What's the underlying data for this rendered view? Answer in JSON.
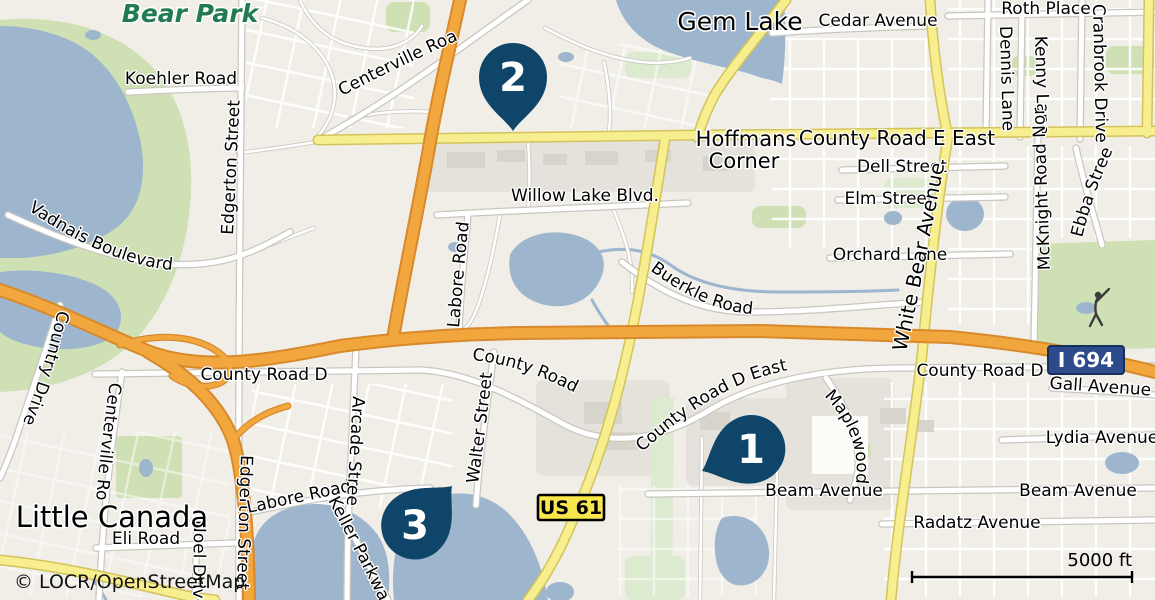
{
  "map": {
    "attribution": "© LOCR/OpenStreetMap",
    "scale": {
      "label": "5000 ft"
    },
    "markers": [
      {
        "number": "1"
      },
      {
        "number": "2"
      },
      {
        "number": "3"
      }
    ],
    "shields": {
      "i694": "I 694",
      "us61": "US 61"
    },
    "place_labels": {
      "bear_park": "Bear Park",
      "gem_lake": "Gem Lake",
      "hoffmans_corner_line1": "Hoffmans",
      "hoffmans_corner_line2": "Corner",
      "little_canada": "Little Canada"
    },
    "road_labels": {
      "koehler_road": "Koehler Road",
      "edgerton_street_north": "Edgerton Street",
      "centerville_road_north": "Centerville Road",
      "cedar_avenue": "Cedar Avenue",
      "roth_place": "Roth Place",
      "dennis_lane": "Dennis Lane",
      "kenny_lane": "Kenny Lane",
      "cranbrook_drive": "Cranbrook Drive",
      "county_road_e_east": "County Road E East",
      "dell_street": "Dell Street",
      "elm_street": "Elm Street",
      "willow_lake_blvd": "Willow Lake Blvd.",
      "orchard_lane": "Orchard Lane",
      "white_bear_avenue": "White Bear Avenue",
      "mcknight_road_north": "McKnight Road North",
      "ebba_street": "Ebba Street",
      "buerkle_road": "Buerkle Road",
      "vadnais_boulevard": "Vadnais Boulevard",
      "country_drive": "Country Drive",
      "centerville_road_south": "Centerville Road",
      "county_road_d_west": "County Road D",
      "county_road_d_mid": "County Road D",
      "county_road_d_east": "County Road D East",
      "county_road_d_right": "County Road D",
      "gall_avenue": "Gall Avenue",
      "lydia_avenue": "Lydia Avenue",
      "maplewood_mall_drive": "Maplewood Mall Drive",
      "beam_avenue_west": "Beam Avenue",
      "beam_avenue_east": "Beam Avenue",
      "radatz_avenue": "Radatz Avenue",
      "eli_road": "Eli Road",
      "noel_drive": "Noel Drive",
      "edgerton_street_south": "Edgerton Street",
      "labore_road_vertical": "Labore Road",
      "labore_road_south": "Labore Road",
      "arcade_street": "Arcade Street",
      "walter_street": "Walter Street",
      "keller_parkway": "Keller Parkway"
    },
    "icons": {
      "golfer": "golf-player"
    },
    "colors": {
      "land": "#f0eee7",
      "urban": "#e4e2da",
      "park": "#cfe0b4",
      "park_light": "#dcead0",
      "park_text": "#217a50",
      "water": "#9db6ce",
      "building": "#d6d4cb",
      "road_casing": "#c9c7bf",
      "yellow": "#f7ef8f",
      "yellow_casing": "#d3c35a",
      "orange": "#f2a73e",
      "orange_casing": "#d8892b",
      "marker": "#0f4569",
      "shield_blue": "#2c4a8c",
      "shield_yellow": "#f9e64b"
    }
  }
}
